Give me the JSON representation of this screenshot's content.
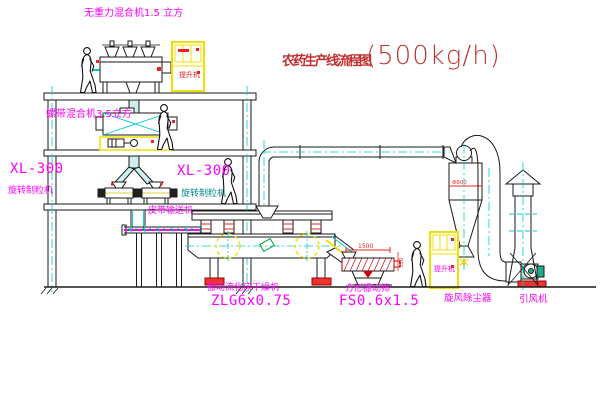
{
  "title": {
    "name": "农药生产线流程图",
    "capacity": "(500kg/h)"
  },
  "equipment": {
    "top_mixer": {
      "label": "无重力混合机1.5 立方"
    },
    "mid_mixer": {
      "label": "螺带混合机3.5立方"
    },
    "left_granulator": {
      "model": "XL-300",
      "name": "旋转制粒机"
    },
    "mid_granulator": {
      "model": "XL-300",
      "name": "旋转制粒机"
    },
    "belt_conveyor": {
      "name": "皮带输送机"
    },
    "dryer": {
      "name": "振动流化床干燥机",
      "model": "ZLG6x0.75"
    },
    "sieve": {
      "name": "方形振动筛",
      "model": "FS0.6x1.5",
      "dim_length": "1500",
      "dim_height": "350"
    },
    "cyclone": {
      "name": "旋风除尘器",
      "dim": "Φ600"
    },
    "fan": {
      "name": "引风机"
    },
    "elevator_top": {
      "label": "提升机"
    },
    "elevator_right": {
      "label": "提升机"
    }
  },
  "colors": {
    "line": "#1a1a1a",
    "magenta": "#ff00ff",
    "cyan": "#00cccc",
    "teal": "#008b8b",
    "yellow": "#f0e000",
    "red": "#ee2222",
    "green": "#00a040",
    "title_red": "#c03030"
  }
}
